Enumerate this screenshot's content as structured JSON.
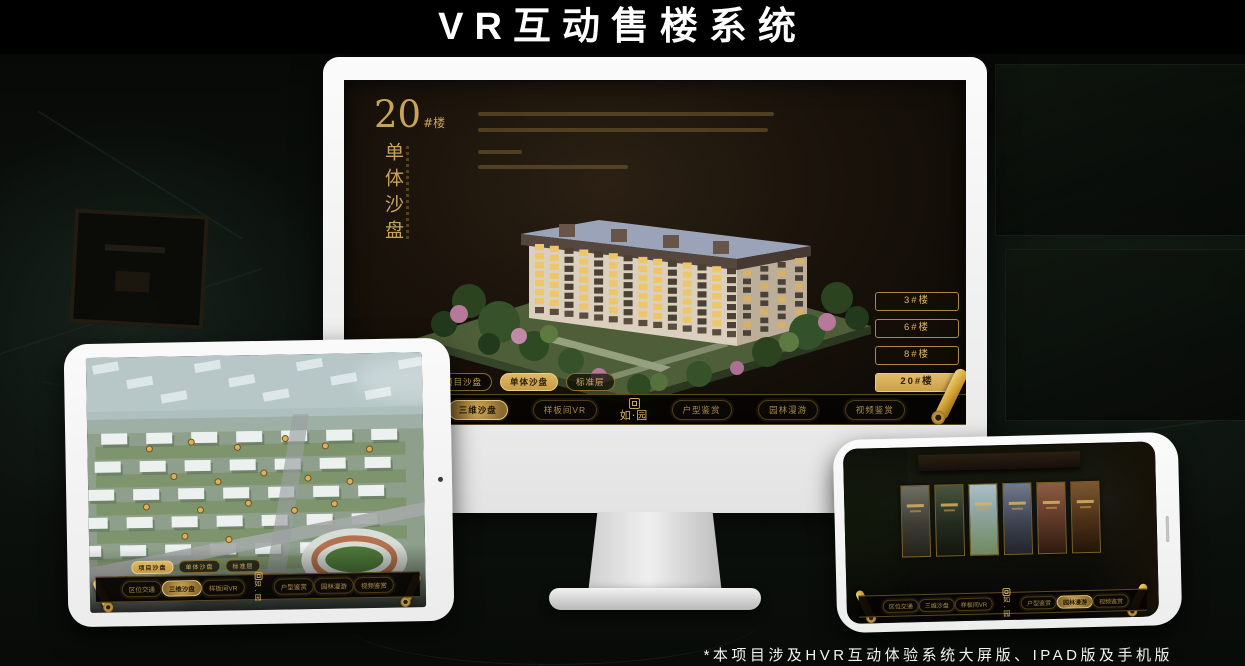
{
  "title": "VR互动售楼系统",
  "footnote": "*本项目涉及HVR互动体验系统大屏版、IPAD版及手机版",
  "brand": {
    "logo_text": "如·园",
    "gold": "#c9a35a",
    "gold_bright": "#e3c276",
    "active_fill": "#d8ae5c",
    "active_text": "#2b1d07"
  },
  "monitor": {
    "unit_number": "20",
    "unit_suffix": "#楼",
    "section_title_vertical": "单体沙盘",
    "floor_buttons": [
      {
        "label": "3#楼",
        "active": false
      },
      {
        "label": "6#楼",
        "active": false
      },
      {
        "label": "8#楼",
        "active": false
      },
      {
        "label": "20#楼",
        "active": true
      }
    ],
    "sub_tabs": [
      {
        "label": "项目沙盘",
        "active": false
      },
      {
        "label": "单体沙盘",
        "active": true
      },
      {
        "label": "标准层",
        "active": false
      }
    ],
    "nav_left": [
      {
        "label": "区位交通",
        "active": false
      },
      {
        "label": "三维沙盘",
        "active": true
      },
      {
        "label": "样板间VR",
        "active": false
      }
    ],
    "nav_right": [
      {
        "label": "户型鉴赏",
        "active": false
      },
      {
        "label": "园林漫游",
        "active": false
      },
      {
        "label": "视频鉴赏",
        "active": false
      }
    ]
  },
  "tablet": {
    "sub_tabs": [
      {
        "label": "项目沙盘",
        "active": true
      },
      {
        "label": "单体沙盘",
        "active": false
      },
      {
        "label": "标准层",
        "active": false
      }
    ],
    "nav_left": [
      {
        "label": "区位交通",
        "active": false
      },
      {
        "label": "三维沙盘",
        "active": true
      },
      {
        "label": "样板间VR",
        "active": false
      }
    ],
    "nav_right": [
      {
        "label": "户型鉴赏",
        "active": false
      },
      {
        "label": "园林漫游",
        "active": false
      },
      {
        "label": "视频鉴赏",
        "active": false
      }
    ]
  },
  "phone": {
    "gallery_count": 6,
    "nav_left": [
      {
        "label": "区位交通",
        "active": false
      },
      {
        "label": "三维沙盘",
        "active": false
      },
      {
        "label": "样板间VR",
        "active": false
      }
    ],
    "nav_right": [
      {
        "label": "户型鉴赏",
        "active": false
      },
      {
        "label": "园林漫游",
        "active": true
      },
      {
        "label": "视频鉴赏",
        "active": false
      }
    ]
  }
}
